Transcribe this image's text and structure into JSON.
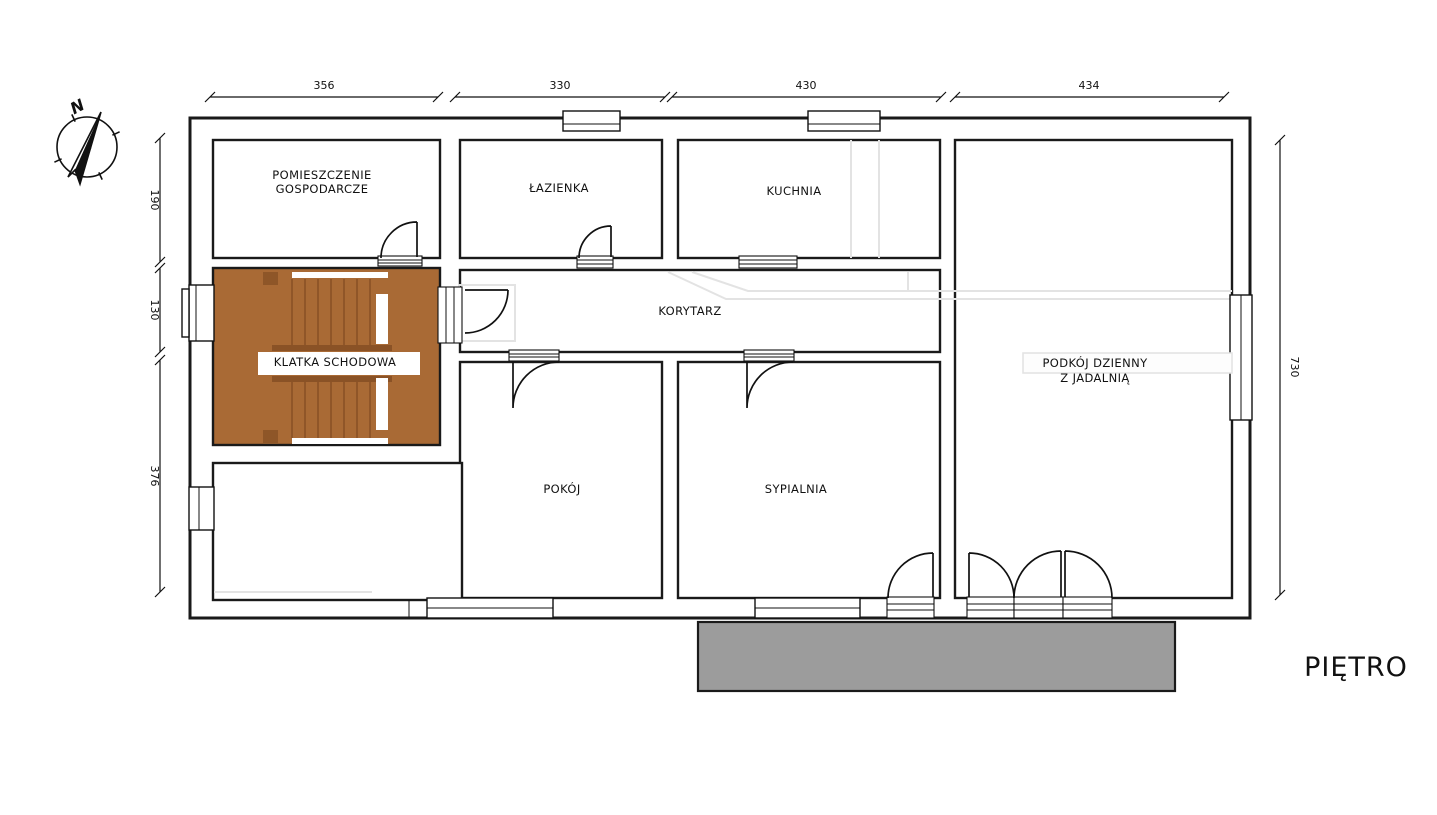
{
  "floor_label": "PIĘTRO",
  "compass": {
    "north": "N"
  },
  "rooms": {
    "utility": {
      "line1": "POMIESZCZENIE",
      "line2": "GOSPODARCZE"
    },
    "bathroom": {
      "label": "ŁAZIENKA"
    },
    "kitchen": {
      "label": "KUCHNIA"
    },
    "corridor": {
      "label": "KORYTARZ"
    },
    "staircase": {
      "label": "KLATKA SCHODOWA"
    },
    "small_room": {
      "label": "POKÓJ"
    },
    "bedroom": {
      "label": "SYPIALNIA"
    },
    "living_room": {
      "line1": "PODKÓJ DZIENNY",
      "line2": "Z JADALNIĄ"
    }
  },
  "dimensions": {
    "top": [
      {
        "value": "356"
      },
      {
        "value": "330"
      },
      {
        "value": "430"
      },
      {
        "value": "434"
      }
    ],
    "left": [
      {
        "value": "190"
      },
      {
        "value": "130"
      },
      {
        "value": "376"
      }
    ],
    "right": [
      {
        "value": "730"
      }
    ]
  },
  "colors": {
    "stairs": "#A96A35",
    "stairs_dark": "#8A5226",
    "balcony": "#9C9C9C",
    "wall": "#1A1A1A",
    "ghost": "#E3E3E3"
  }
}
